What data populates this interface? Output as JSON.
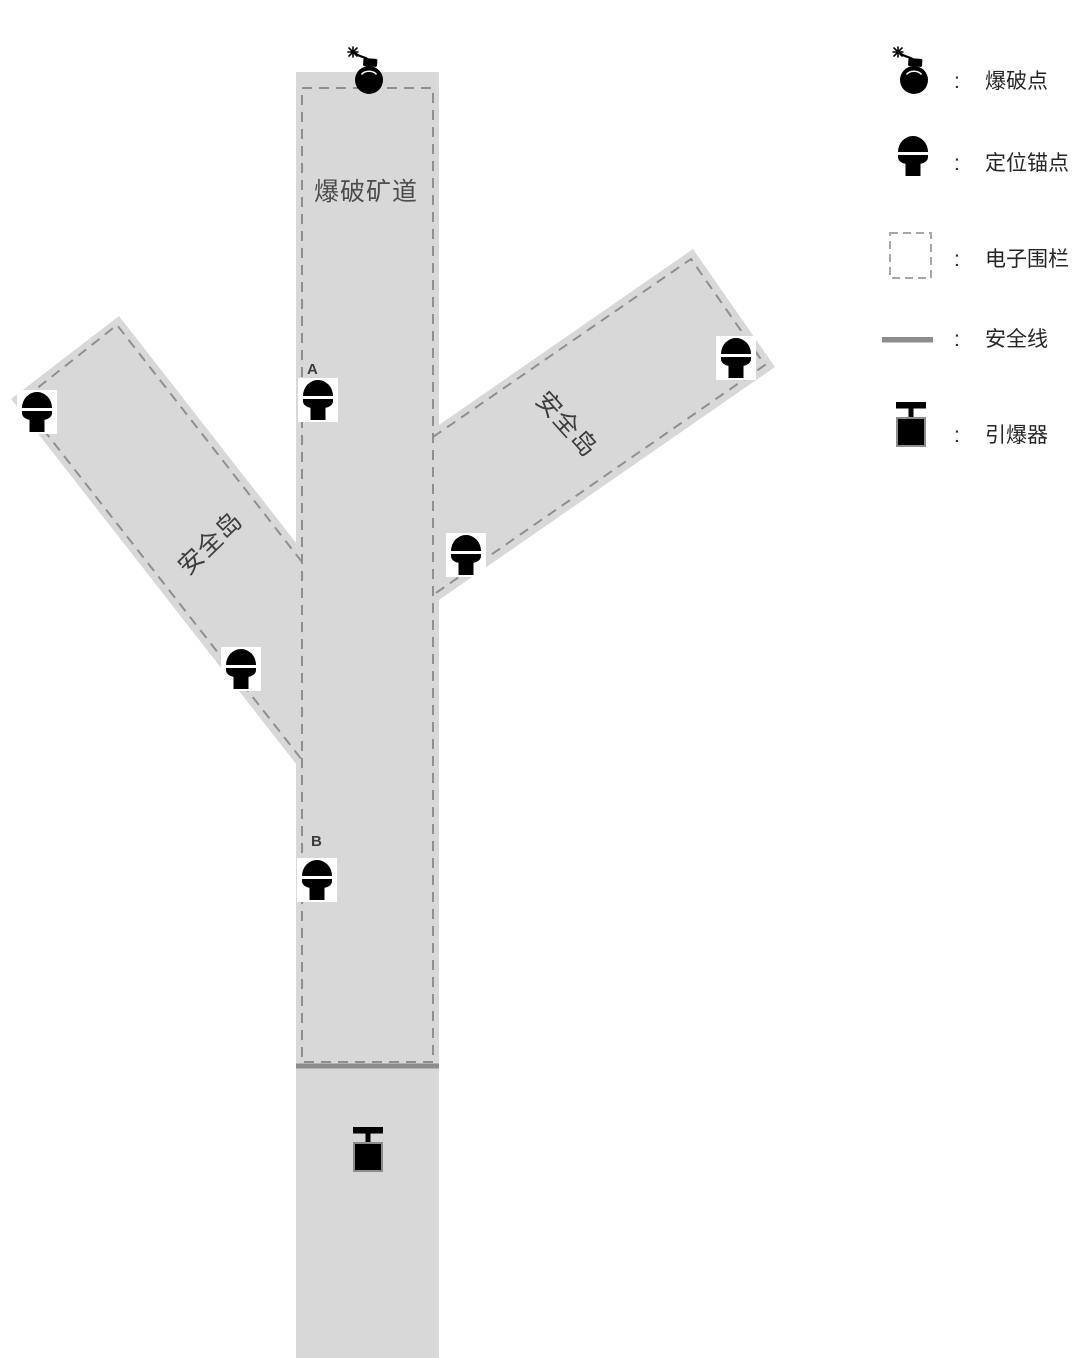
{
  "diagram": {
    "tunnel_label": "爆破矿道",
    "left_island_label": "安全岛",
    "right_island_label": "安全岛",
    "anchor_a_label": "A",
    "anchor_b_label": "B"
  },
  "legend": {
    "separator": ":",
    "items": [
      {
        "icon": "bomb-icon",
        "label": "爆破点"
      },
      {
        "icon": "anchor-icon",
        "label": "定位锚点"
      },
      {
        "icon": "fence-icon",
        "label": "电子围栏"
      },
      {
        "icon": "safety-line-icon",
        "label": "安全线"
      },
      {
        "icon": "detonator-icon",
        "label": "引爆器"
      }
    ]
  },
  "colors": {
    "area_fill": "#d8d8d8",
    "fence_dash": "#8f8f8f",
    "legend_fence_dash": "#a6a6a6",
    "safety_line": "#8c8c8c",
    "icon_fill": "#000000"
  }
}
